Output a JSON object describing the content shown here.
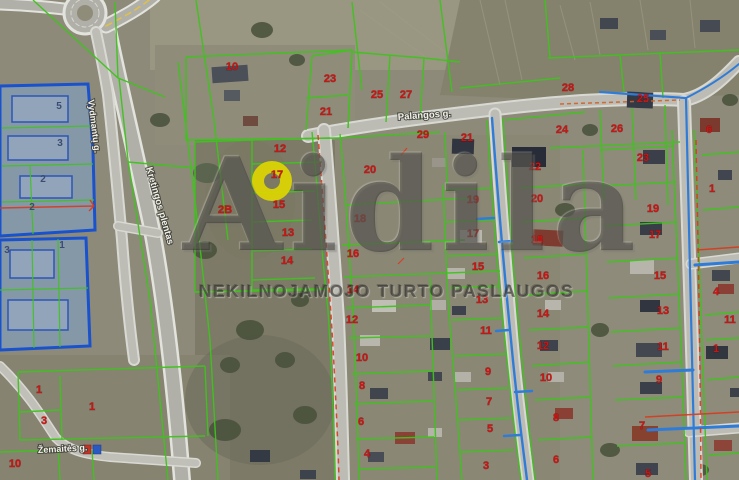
{
  "map": {
    "watermark": {
      "brand": "Aidila",
      "tagline": "NEKILNOJAMOJO TURTO PASLAUGOS"
    },
    "colors": {
      "parcel_line_green": "#3ec41c",
      "parcel_number_red": "#cf1212",
      "blue_zone_number": "#3b4c74",
      "selection_yellow": "#dcd600",
      "water_line_blue": "#2f7cd8",
      "boundary_red": "#d93a1d",
      "blue_zone_fill": "#7da6d8",
      "street_label_text": "#f2f1e8"
    },
    "street_labels": [
      {
        "name": "Palangos g.",
        "x": 398,
        "y": 120,
        "rotate": -4,
        "size": 9.5
      },
      {
        "name": "Kretingos plentas",
        "x": 146,
        "y": 168,
        "rotate": 74,
        "size": 9.5
      },
      {
        "name": "Vydmantų g.",
        "x": 88,
        "y": 100,
        "rotate": 83,
        "size": 9
      },
      {
        "name": "Žemaitės g.",
        "x": 38,
        "y": 453,
        "rotate": -3,
        "size": 9
      }
    ],
    "selected_parcel": {
      "number": "17",
      "x": 272,
      "y": 181
    },
    "parcel_numbers": [
      {
        "n": "10",
        "x": 232,
        "y": 70
      },
      {
        "n": "23",
        "x": 330,
        "y": 82
      },
      {
        "n": "25",
        "x": 377,
        "y": 98
      },
      {
        "n": "27",
        "x": 406,
        "y": 98
      },
      {
        "n": "21",
        "x": 326,
        "y": 115
      },
      {
        "n": "28",
        "x": 568,
        "y": 91
      },
      {
        "n": "25",
        "x": 643,
        "y": 102
      },
      {
        "n": "29",
        "x": 423,
        "y": 138
      },
      {
        "n": "21",
        "x": 467,
        "y": 141
      },
      {
        "n": "24",
        "x": 562,
        "y": 133
      },
      {
        "n": "26",
        "x": 617,
        "y": 132
      },
      {
        "n": "22",
        "x": 535,
        "y": 170
      },
      {
        "n": "23",
        "x": 643,
        "y": 161
      },
      {
        "n": "12",
        "x": 280,
        "y": 152
      },
      {
        "n": "17",
        "x": 277,
        "y": 178
      },
      {
        "n": "20",
        "x": 370,
        "y": 173
      },
      {
        "n": "15",
        "x": 279,
        "y": 208
      },
      {
        "n": "2B",
        "x": 225,
        "y": 213
      },
      {
        "n": "18",
        "x": 360,
        "y": 222
      },
      {
        "n": "13",
        "x": 288,
        "y": 236
      },
      {
        "n": "16",
        "x": 353,
        "y": 257
      },
      {
        "n": "14",
        "x": 287,
        "y": 264
      },
      {
        "n": "19",
        "x": 473,
        "y": 203
      },
      {
        "n": "17",
        "x": 473,
        "y": 237
      },
      {
        "n": "15",
        "x": 478,
        "y": 270
      },
      {
        "n": "13",
        "x": 482,
        "y": 303
      },
      {
        "n": "11",
        "x": 486,
        "y": 334
      },
      {
        "n": "9",
        "x": 488,
        "y": 375
      },
      {
        "n": "7",
        "x": 489,
        "y": 405
      },
      {
        "n": "5",
        "x": 490,
        "y": 432
      },
      {
        "n": "3",
        "x": 486,
        "y": 469
      },
      {
        "n": "20",
        "x": 537,
        "y": 202
      },
      {
        "n": "18",
        "x": 537,
        "y": 243
      },
      {
        "n": "16",
        "x": 543,
        "y": 279
      },
      {
        "n": "14",
        "x": 543,
        "y": 317
      },
      {
        "n": "12",
        "x": 543,
        "y": 349
      },
      {
        "n": "10",
        "x": 546,
        "y": 381
      },
      {
        "n": "8",
        "x": 556,
        "y": 421
      },
      {
        "n": "6",
        "x": 556,
        "y": 463
      },
      {
        "n": "14",
        "x": 353,
        "y": 293
      },
      {
        "n": "12",
        "x": 352,
        "y": 323
      },
      {
        "n": "10",
        "x": 362,
        "y": 361
      },
      {
        "n": "8",
        "x": 362,
        "y": 389
      },
      {
        "n": "6",
        "x": 361,
        "y": 425
      },
      {
        "n": "4",
        "x": 367,
        "y": 457
      },
      {
        "n": "19",
        "x": 653,
        "y": 212
      },
      {
        "n": "17",
        "x": 655,
        "y": 238
      },
      {
        "n": "15",
        "x": 660,
        "y": 279
      },
      {
        "n": "13",
        "x": 663,
        "y": 314
      },
      {
        "n": "11",
        "x": 663,
        "y": 350
      },
      {
        "n": "9",
        "x": 659,
        "y": 383
      },
      {
        "n": "7",
        "x": 642,
        "y": 429
      },
      {
        "n": "5",
        "x": 648,
        "y": 477
      },
      {
        "n": "6",
        "x": 709,
        "y": 133
      },
      {
        "n": "1",
        "x": 712,
        "y": 192
      },
      {
        "n": "4",
        "x": 716,
        "y": 295
      },
      {
        "n": "11",
        "x": 730,
        "y": 323
      },
      {
        "n": "1",
        "x": 716,
        "y": 352
      },
      {
        "n": "1",
        "x": 39,
        "y": 393
      },
      {
        "n": "1",
        "x": 92,
        "y": 410
      },
      {
        "n": "3",
        "x": 44,
        "y": 424
      },
      {
        "n": "10",
        "x": 15,
        "y": 467
      }
    ],
    "blue_zone_numbers": [
      {
        "n": "5",
        "x": 59,
        "y": 109
      },
      {
        "n": "3",
        "x": 60,
        "y": 146
      },
      {
        "n": "2",
        "x": 43,
        "y": 182
      },
      {
        "n": "2",
        "x": 32,
        "y": 210
      },
      {
        "n": "3",
        "x": 7,
        "y": 253
      },
      {
        "n": "1",
        "x": 62,
        "y": 248
      }
    ]
  }
}
